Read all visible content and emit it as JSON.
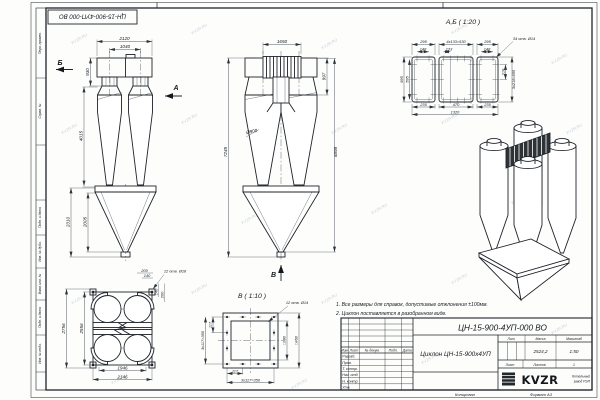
{
  "watermark": "KVZR.RU",
  "stamp": "ЦН-15-900-4УП-000 ВО",
  "margin": {
    "labels": [
      "Перв. примен.",
      "Справ. №",
      "Подп. и дата",
      "Инв. № дубл.",
      "Взам. инв. №",
      "Подп. и дата",
      "Инв. № подл."
    ]
  },
  "front_view": {
    "label_b": "Б",
    "label_a": "А",
    "dim_top": "2120",
    "dim_inner": "1040",
    "dim_box_h": "930",
    "dim_body_h": "4015",
    "dim_cone_h1": "2310",
    "dim_cone_h2": "2005"
  },
  "side_view": {
    "dim_top": "1650",
    "dim_inlet_h": "997",
    "dim_total_h": "7245",
    "dim_right_h": "6898",
    "dia": "Ø900",
    "label_v": "В"
  },
  "detail_ab": {
    "title": "А,Б ( 1:20 )",
    "top": [
      "295",
      "4x133=530",
      "295"
    ],
    "sub": [
      "148",
      "133",
      "148"
    ],
    "holes": "34 отв. Ø14",
    "left": [
      "695",
      "595"
    ],
    "right": [
      "218",
      "3x218=655"
    ],
    "bottom": [
      "235",
      "470",
      "235"
    ],
    "total": "1320"
  },
  "plan_view": {
    "dim_outer_v": "2756",
    "dim_inner_v": "2556",
    "dim_inner_h": "1946",
    "dim_outer_h": "2146",
    "holes": "12 отв. Ø18",
    "small_top": [
      "200",
      "140"
    ],
    "small_right": [
      "140",
      "200"
    ]
  },
  "detail_v": {
    "title": "В ( 1:10 )",
    "holes": "12 отв. Ø14",
    "left": [
      "117",
      "3x117=350"
    ],
    "bottom": [
      "117",
      "3x117=350"
    ],
    "sq_inner": "□380",
    "sq_outer": "□460"
  },
  "notes": [
    "1. Все размеры для справок, допустимые отклонения ±100мм.",
    "2. Циклон поставляется в разобранном виде."
  ],
  "title_block": {
    "designation": "ЦН-15-900-4УП-000 ВО",
    "name": "Циклон ЦН-15-900х4УП",
    "lit_label": "Лит.",
    "mass_label": "Масса",
    "scale_label": "Масштаб",
    "mass": "2524,2",
    "scale": "1:50",
    "sheet_label": "Лист",
    "sheets_label": "Листов",
    "sheets_value": "1",
    "header": [
      "Изм",
      "Лист",
      "№ докум.",
      "Подп.",
      "Дата"
    ],
    "rows": [
      "Разраб.",
      "Пров.",
      "Т. контр.",
      "Нач. отд.",
      "Н. контр.",
      "Утв."
    ],
    "logo": "KVZR",
    "logo_line1": "Котельный",
    "logo_line2": "завод РЭП",
    "copied": "Копировал",
    "format": "Формат А3"
  }
}
